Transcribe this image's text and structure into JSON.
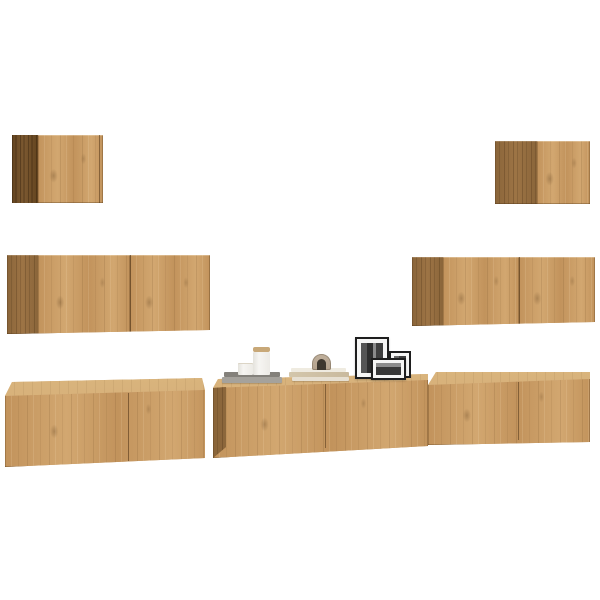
{
  "scene": {
    "type": "furniture-product-photo",
    "subject": "7-piece wall-mounted TV cabinet set in artisan oak with decor, on plain white background",
    "items": [
      {
        "id": "wall-cabinet-top-left",
        "kind": "small square wall cabinet, one door, dark side panel"
      },
      {
        "id": "wall-cabinet-top-right",
        "kind": "small square wall cabinet, one door, side panel"
      },
      {
        "id": "wall-cabinet-mid-left",
        "kind": "wide wall cabinet, two doors"
      },
      {
        "id": "wall-cabinet-mid-right",
        "kind": "wide wall cabinet, two doors"
      },
      {
        "id": "tv-cabinet-bottom-left",
        "kind": "low TV cabinet, two doors, top visible"
      },
      {
        "id": "tv-cabinet-bottom-center",
        "kind": "low TV cabinet, two doors, decor on top"
      },
      {
        "id": "tv-cabinet-bottom-right",
        "kind": "low TV cabinet, two doors, top visible"
      },
      {
        "id": "tray",
        "kind": "grey decorative tray stack"
      },
      {
        "id": "candle-short",
        "kind": "short white pillar candle"
      },
      {
        "id": "candle-tall",
        "kind": "tall white candle jar with wooden lid"
      },
      {
        "id": "book-stack",
        "kind": "stack of cream books"
      },
      {
        "id": "arch-ornament",
        "kind": "small arch ornament on books"
      },
      {
        "id": "frame-large",
        "kind": "large black photo frame, portrait, b/w picture"
      },
      {
        "id": "frame-small",
        "kind": "small black photo frame, portrait, b/w picture"
      },
      {
        "id": "frame-medium",
        "kind": "medium black photo frame, landscape, b/w picture"
      }
    ]
  },
  "colors": {
    "bg": "#ffffff",
    "wood_front": "#c2935c",
    "wood_front_light": "#d2a770",
    "wood_side": "#9d7445",
    "wood_side_dark": "#8a653a",
    "wood_top": "#d9b47d",
    "wood_walnut": "#7c5931",
    "wood_walnut_dark": "#63441f",
    "seam_line": "rgba(80,53,23,0.55)",
    "tray_top": "#84817b",
    "tray_base": "#a5a29c",
    "candle": "#f6f5f2",
    "candle_lid": "#c8a878",
    "book_light": "#efebe0",
    "book_pages": "#d3c6ab",
    "book_mid": "#e6dfd1",
    "arch": "#b4a28d",
    "arch_inner": "#3e382f",
    "frame": "#1e1e1e",
    "frame_mat": "#f6f6f5",
    "photo_dark": "#3f3f3f"
  }
}
